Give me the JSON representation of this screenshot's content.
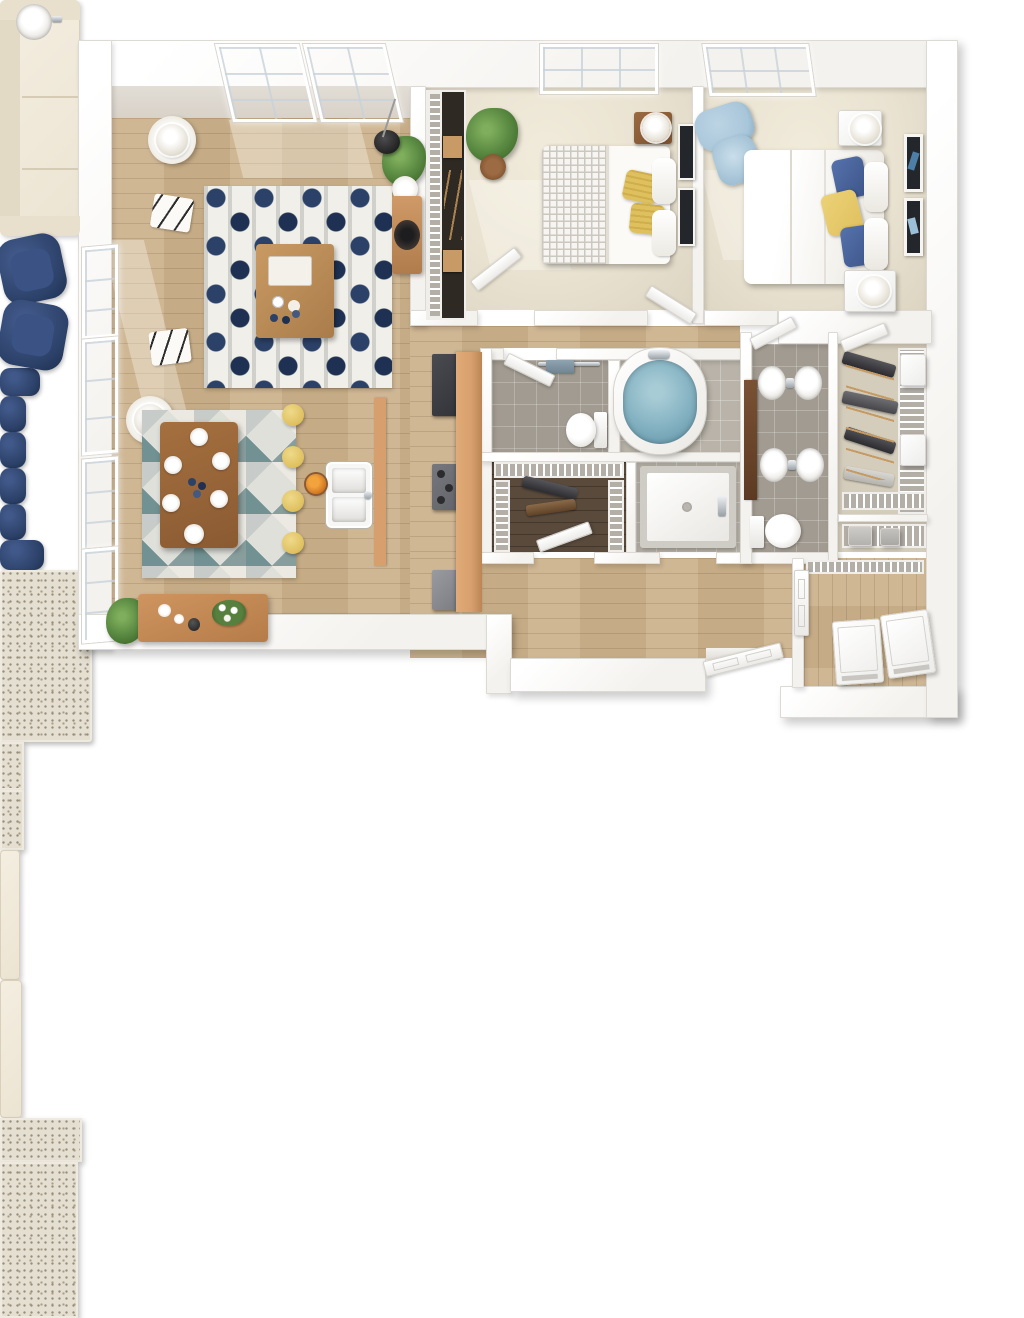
{
  "scene": {
    "type": "3d-floorplan-render",
    "description": "top-down 3d rendering of a two-bedroom two-bath apartment, no text labels"
  },
  "palette": {
    "wall": "#f4f2ee",
    "wall_edge": "#ddd9d3",
    "wall_face": "#d8d2c9",
    "wood": "#ccb28c",
    "carpet": "#e9e2d1",
    "tile": "#a29b91",
    "tile_light": "#b9b3a9",
    "darkwood": "#594a3c",
    "tan_floor": "#d5cdbb",
    "navy": "#2c4168",
    "cream": "#ece4d2",
    "yellow": "#dfc05e",
    "blue_light": "#a9c6da",
    "water": "#83b1c1",
    "green": "#56863f",
    "granite": "#e5dfd2",
    "speckle": "#968f7d",
    "counter_wood": "#d79f6d",
    "appliance_dark": "#33343a",
    "appliance_gray": "#62646a",
    "chrome": "#9aa2a9",
    "wire_base": "#b3aea6",
    "frame_dark": "#23262b",
    "rug_white": "#f1efe9"
  },
  "rooms": [
    {
      "name": "living-room",
      "furniture": [
        "cream-sofa",
        "two-side-tables-with-lamps",
        "two-navy-armchairs",
        "navy-pattern-rug",
        "wood-coffee-table",
        "arc-floor-lamp",
        "potted-plant",
        "media-console"
      ]
    },
    {
      "name": "dining-area",
      "furniture": [
        "wood-dining-table",
        "six-navy-chairs",
        "geometric-triangle-rug",
        "six-place-settings"
      ]
    },
    {
      "name": "kitchen",
      "furniture": [
        "granite-island",
        "double-basin-sink",
        "four-yellow-stools",
        "fruit-bowl",
        "counter-run",
        "refrigerator",
        "range",
        "dishwasher"
      ]
    },
    {
      "name": "entry",
      "furniture": [
        "wood-console-with-flowers",
        "potted-plant",
        "open-front-door"
      ]
    },
    {
      "name": "bedroom-1",
      "furniture": [
        "bed-with-yellow-pillows",
        "greek-key-blanket",
        "nightstand-with-lamp",
        "two-wall-art-frames",
        "potted-plant",
        "reach-in-closet-wire-shelving"
      ]
    },
    {
      "name": "bedroom-2",
      "furniture": [
        "bed-with-blue-and-yellow-pillows",
        "two-nightstands-with-lamps",
        "two-wall-art-frames",
        "light-blue-accent-chair"
      ]
    },
    {
      "name": "bathroom-1",
      "furniture": [
        "single-vanity-round-sink",
        "toilet",
        "soaking-tub-filled",
        "towel-bar"
      ]
    },
    {
      "name": "bathroom-2",
      "furniture": [
        "double-granite-vanity",
        "toilet",
        "walk-in-shower"
      ]
    },
    {
      "name": "walk-in-closet-1",
      "furniture": [
        "wire-shelving",
        "clothes"
      ]
    },
    {
      "name": "walk-in-closet-2",
      "furniture": [
        "wire-shelving",
        "hanging-clothes",
        "storage-baskets"
      ]
    },
    {
      "name": "linen-closet",
      "furniture": [
        "wire-shelf",
        "storage-boxes"
      ]
    },
    {
      "name": "laundry-room",
      "furniture": [
        "washer",
        "dryer",
        "wire-shelf",
        "door"
      ]
    }
  ]
}
